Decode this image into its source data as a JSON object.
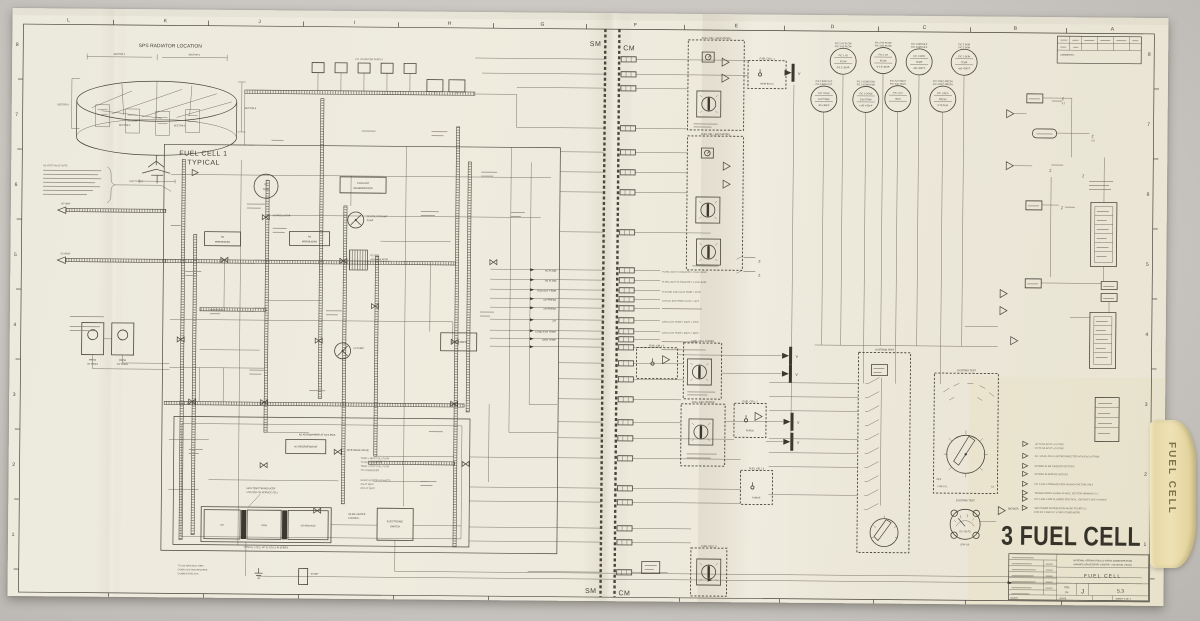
{
  "fold": {
    "sm": "SM",
    "cm": "CM"
  },
  "grid": {
    "top_letters": [
      "L",
      "K",
      "J",
      "I",
      "H",
      "G",
      "F",
      "E",
      "D",
      "C",
      "B",
      "A"
    ],
    "left_numbers": [
      "8",
      "7",
      "6",
      "5",
      "4",
      "3",
      "2",
      "1"
    ],
    "right_numbers": [
      "8",
      "7",
      "6",
      "5",
      "4",
      "3",
      "2",
      "1"
    ]
  },
  "revision": {
    "comments": "COMMENTS:"
  },
  "radiator": {
    "title": "SPS RADIATOR LOCATION",
    "sectors": [
      "SECTOR 2",
      "SECTOR 3",
      "SECTOR 5",
      "SECTOR 6"
    ]
  },
  "side_note": {
    "title": "N2 VENT VALVE NOTE",
    "gse": "GSE POWER"
  },
  "fuel_cell": {
    "title1": "FUEL CELL 1",
    "title2": "TYPICAL",
    "radiator_chain": "F/C 1 RADIATOR PANELS",
    "n2_tank1": "N2",
    "n2_tank2": "TANK",
    "n2_reg": "N2 REGULATOR",
    "n2_preheater1": "N2",
    "n2_preheater2": "PREHEATER",
    "h2_preheater1": "H2",
    "h2_preheater2": "PREHEATER",
    "coolant_regen1": "COOLANT",
    "coolant_regen2": "REGENERATOR",
    "glycol_pump1": "GLYCOL COOLANT",
    "glycol_pump2": "PUMP",
    "glycol_accum1": "GLYCOL",
    "glycol_accum2": "ACCUMULATOR",
    "h2_pump": "H2 PUMP",
    "condenser": "CONDENSER",
    "h2_regen": "H2 REGENERATOR",
    "n2_bypass": "N2 BYPASS VALVE",
    "bypass1": "TEMP > 485°F FULL FLOW",
    "bypass2": "TO REGENERATOR",
    "bypass3": "TEMP < 470°F FULL FLOW",
    "bypass4": "TO CONDENSER",
    "atm_note": "N2 ATMOSPHERE AT 53.5 PSIA",
    "heater1": "INLINE HEATER 160 WATTS",
    "heater2": "ON AT 385°F",
    "heater3": "OFF AT 390°F",
    "hctl1": "INLINE HEATER",
    "hctl2": "CONTROL",
    "skin1": "SKIN TEMP TRANSDUCER",
    "skin2": "LOCATED ON SERVICE CELL",
    "es1": "ELECTRONIC",
    "es2": "SWITCH",
    "cell_o2": "O2",
    "cell_koh": "KOH",
    "cell_h2": "H2 AND H2O",
    "cell_cap": "TYPICAL 1 CELL OF 31 CELLS IN SERIES",
    "from_h2a": "FROM",
    "from_h2b": "H2 TANKS",
    "from_o2a": "FROM",
    "from_o2b": "O2 TANKS",
    "h2_vent": "H2 VENT",
    "o2_vent": "O2 VENT"
  },
  "signals": {
    "labels": [
      "H2 FLOW",
      "O2 FLOW",
      "RAD OUT TEMP",
      "O2 PRESS",
      "H2 PRESS",
      "pH",
      "COND EXH TEMP",
      "SKIN TEMP"
    ]
  },
  "cm": {
    "indicators_title": "FUEL CELL INDICATORS",
    "fc1": "FUEL CELL 1",
    "fc2": "FUEL CELL 2",
    "fc3": "FUEL CELL 3",
    "pumps": "FUEL CELL PUMPS",
    "purge_panel": "FUEL CELL PURGE",
    "main_bus": "MAIN BUS A",
    "purge_sw": "PURGE",
    "vlabel": "V",
    "z": "Z",
    "zref": "5.2",
    "texts": [
      "FLOW LIGHT, FLOW RATE > 0.161 LB/HR",
      "FLOW LIGHT, FLOW RATE > 1.276 LB/HR",
      "TLM AND CAB LIGHT, TEMP > 475°F",
      "GLYCOL RAD TEMP LIGHT < -30°F",
      "CAB LIGHT, TEMP > 250°F < 175°F",
      "CAB LIGHT, TEMP > 500°F < 360°F"
    ],
    "meters": [
      {
        "top1": "F/C 2 H2 FLOW",
        "top2": "F/C 3 H2 FLOW",
        "l1": "F/C 1 H2",
        "l2": "FLOW",
        "rng": "0-0.2 LB/HR"
      },
      {
        "top1": "F/C 2 O2 FLOW",
        "top2": "F/C 3 O2 FLOW",
        "l1": "F/C 1 O2",
        "l2": "FLOW",
        "rng": "0-1.6 LB/HR"
      },
      {
        "top1": "F/C 2 MODULE",
        "top2": "F/C 3 MODULE",
        "l1": "F/C 1 MOD",
        "l2": "TEMP",
        "rng": "+80 +500°F"
      },
      {
        "top1": "F/C 2 SKIN",
        "top2": "F/C 3 SKIN",
        "l1": "F/C 1 SKIN",
        "l2": "TEMP",
        "rng": "+80 +550°F"
      },
      {
        "top1": "F/C 2 RAD OUT",
        "top2": "F/C 3 RAD OUT",
        "l1": "F/C 1 RAD",
        "l2": "OUT TEMP",
        "rng": "-50 +300°F"
      },
      {
        "top1": "F/C 2 COND EXH",
        "top2": "F/C 3 COND EXH",
        "l1": "F/C 1 COND",
        "l2": "EXH TEMP",
        "rng": "+145 +250°F"
      },
      {
        "top1": "F/C 2 pH HIGH",
        "top2": "F/C 3 pH HIGH",
        "l1": "F/C 1 pH",
        "l2": "HIGH",
        "rng": ""
      },
      {
        "top1": "F/C 2 REG PRESS",
        "top2": "F/C 3 REG PRESS",
        "l1": "F/C 1 REG",
        "l2": "PRESS",
        "rng": "0-75 PSIA"
      }
    ],
    "systems_test": "SYSTEMS TEST",
    "low_lvl": "LOW LVL",
    "dc_volts": "DC VOLTS",
    "off": "OFF",
    "ref": "5.1"
  },
  "notes": {
    "label": "NOTES:",
    "items": [
      "H2 TO N2 ΔP AT ± 0.5 PSID",
      "O2 TO N2 ΔP AT ± 0.5 PSID",
      "ALL 3 FUEL CELLS INTERCONNECTED WITH EACH OTHER",
      "STORED IN SM OXIDIZER SECTORS",
      "STORED IN SERVICE MODULE",
      "F/C 2 AND 3 TRANSDUCERS SHOWN ONE TIME ONLY",
      "TRANSDUCERS SHOWN IN MISC. SECTION DRAWING 2.3",
      "F/C 2 AND 3 ARE PLUMBED IDENTICAL, SWITCHES ONLY SHOWN",
      "SEE POWER DISTRIBUTION MICRO FIGURE 5.2",
      "FOR F/C 2 AND F/C 3 CIRCUIT BREAKERS"
    ]
  },
  "bottom": {
    "l1": "TO CM MAIN BUS THRU",
    "l2": "OVERLOAD AND REVERSE",
    "l3": "CURRENT RELAYS",
    "shunt": "SHUNT"
  },
  "banner": "3 FUEL CELL",
  "title_block": {
    "agency1": "NATIONAL AERONAUTICS & SPACE ADMINISTRATION",
    "agency2": "MANNED SPACECRAFT CENTER · HOUSTON, TEXAS",
    "title": "FUEL CELL",
    "item_label": "ITEM",
    "item": "CM",
    "size": "J",
    "dwg_no": "5.3",
    "scale_label": "SCALE",
    "date": "9-6-66",
    "sheet": "SHEET 1 OF 1"
  },
  "tab": {
    "label": "FUEL CELL"
  }
}
